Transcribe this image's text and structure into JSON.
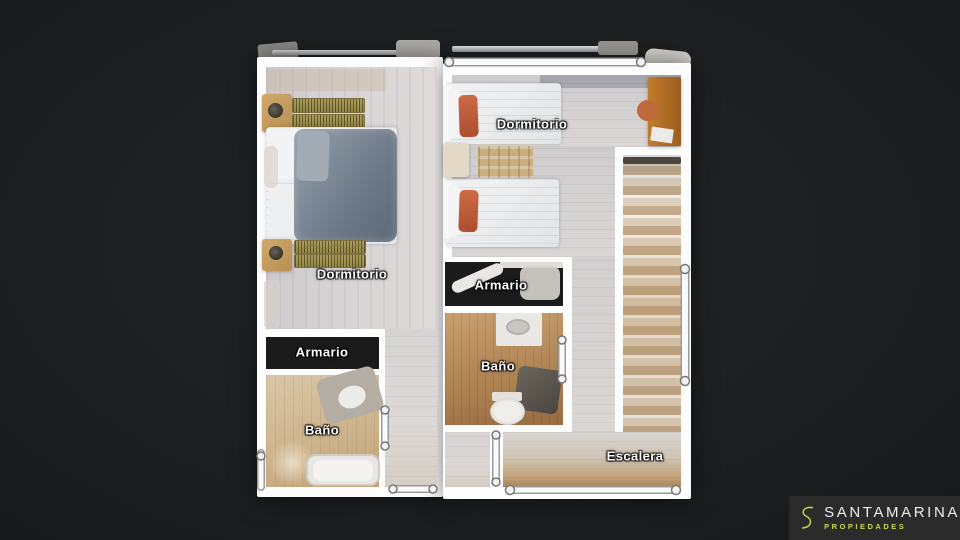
{
  "plan": {
    "rooms": {
      "dormitorio_left": {
        "label": "Dormitorio"
      },
      "dormitorio_right": {
        "label": "Dormitorio"
      },
      "armario_center": {
        "label": "Armario"
      },
      "bano_center": {
        "label": "Baño"
      },
      "armario_left": {
        "label": "Armario"
      },
      "bano_left": {
        "label": "Baño"
      },
      "escalera": {
        "label": "Escalera"
      }
    },
    "wall_color": "#ffffff",
    "floor_light_color": "#d6d3d4",
    "floor_warm_color": "#ab7f50"
  },
  "logo": {
    "mark": "S",
    "brand": "SANTAMARINA",
    "tagline": "PROPIEDADES",
    "accent_color": "#c9d64f",
    "brand_color": "#ededed",
    "panel_color": "#2a2b2a"
  },
  "background_color": "#1d1f21"
}
